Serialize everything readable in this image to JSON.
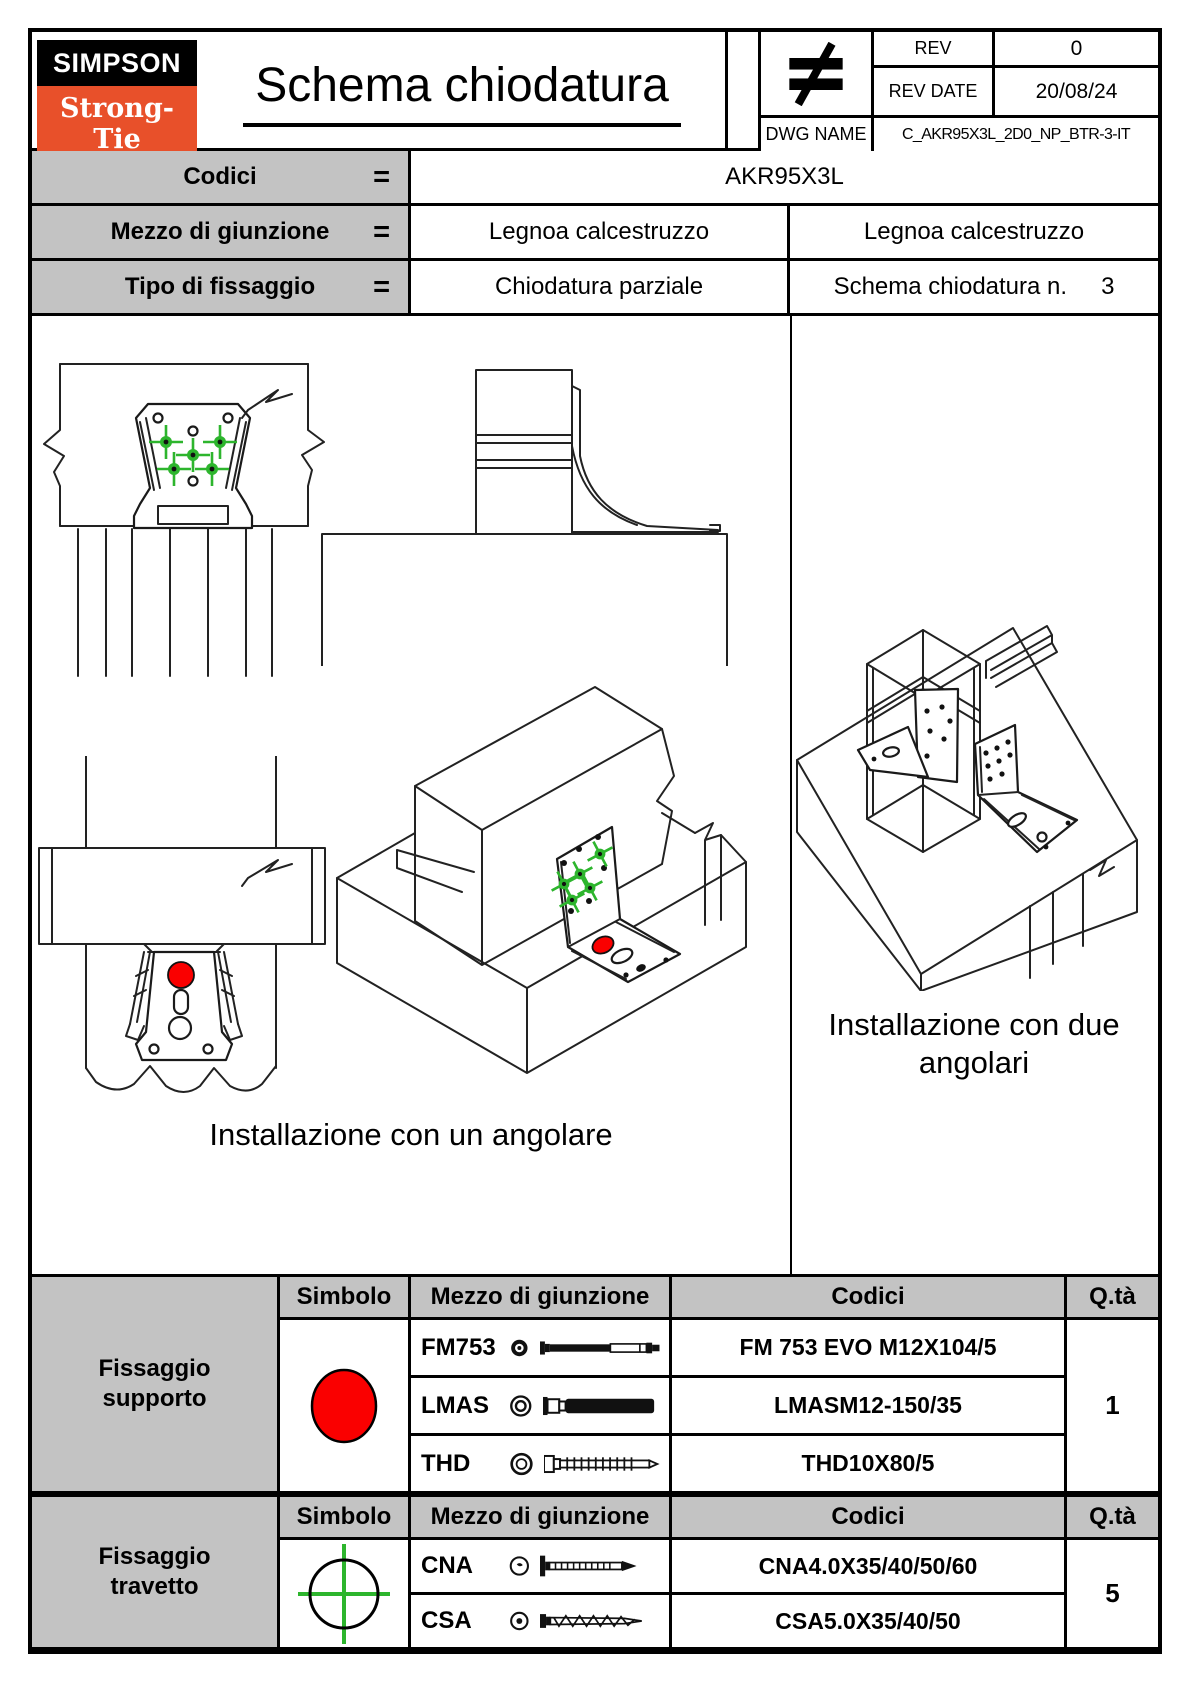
{
  "colors": {
    "accent_orange": "#e8502a",
    "table_gray": "#c3c3c3",
    "marker_green": "#2db52d",
    "anchor_red": "#fa0000"
  },
  "header": {
    "logo_line1": "SIMPSON",
    "logo_line2": "Strong-Tie",
    "logo_mark": "®",
    "title": "Schema chiodatura",
    "rev_label": "REV",
    "rev_value": "0",
    "rev_date_label": "REV DATE",
    "rev_date_value": "20/08/24",
    "dwg_name_label": "DWG NAME",
    "dwg_name_value": "C_AKR95X3L_2D0_NP_BTR-3-IT"
  },
  "info": {
    "equals_sign": "=",
    "codici_label": "Codici",
    "codici_value": "AKR95X3L",
    "mezzo_label": "Mezzo di giunzione",
    "mezzo_value_left": "Legnoa calcestruzzo",
    "mezzo_value_right": "Legnoa calcestruzzo",
    "tipo_label": "Tipo di fissaggio",
    "tipo_value": "Chiodatura parziale",
    "schema_label": "Schema chiodatura n.",
    "schema_number": "3"
  },
  "drawings": {
    "caption_single": "Installazione con un angolare",
    "caption_double": "Installazione con due angolari"
  },
  "support_table": {
    "group_label": "Fissaggio supporto",
    "col_symbol": "Simbolo",
    "col_means": "Mezzo di giunzione",
    "col_codes": "Codici",
    "col_qty": "Q.tà",
    "rows": [
      {
        "name": "FM753",
        "code": "FM 753 EVO M12X104/5"
      },
      {
        "name": "LMAS",
        "code": "LMASM12-150/35"
      },
      {
        "name": "THD",
        "code": "THD10X80/5"
      }
    ],
    "qty": "1"
  },
  "joist_table": {
    "group_label": "Fissaggio travetto",
    "col_symbol": "Simbolo",
    "col_means": "Mezzo di giunzione",
    "col_codes": "Codici",
    "col_qty": "Q.tà",
    "rows": [
      {
        "name": "CNA",
        "code": "CNA4.0X35/40/50/60"
      },
      {
        "name": "CSA",
        "code": "CSA5.0X35/40/50"
      }
    ],
    "qty": "5"
  }
}
